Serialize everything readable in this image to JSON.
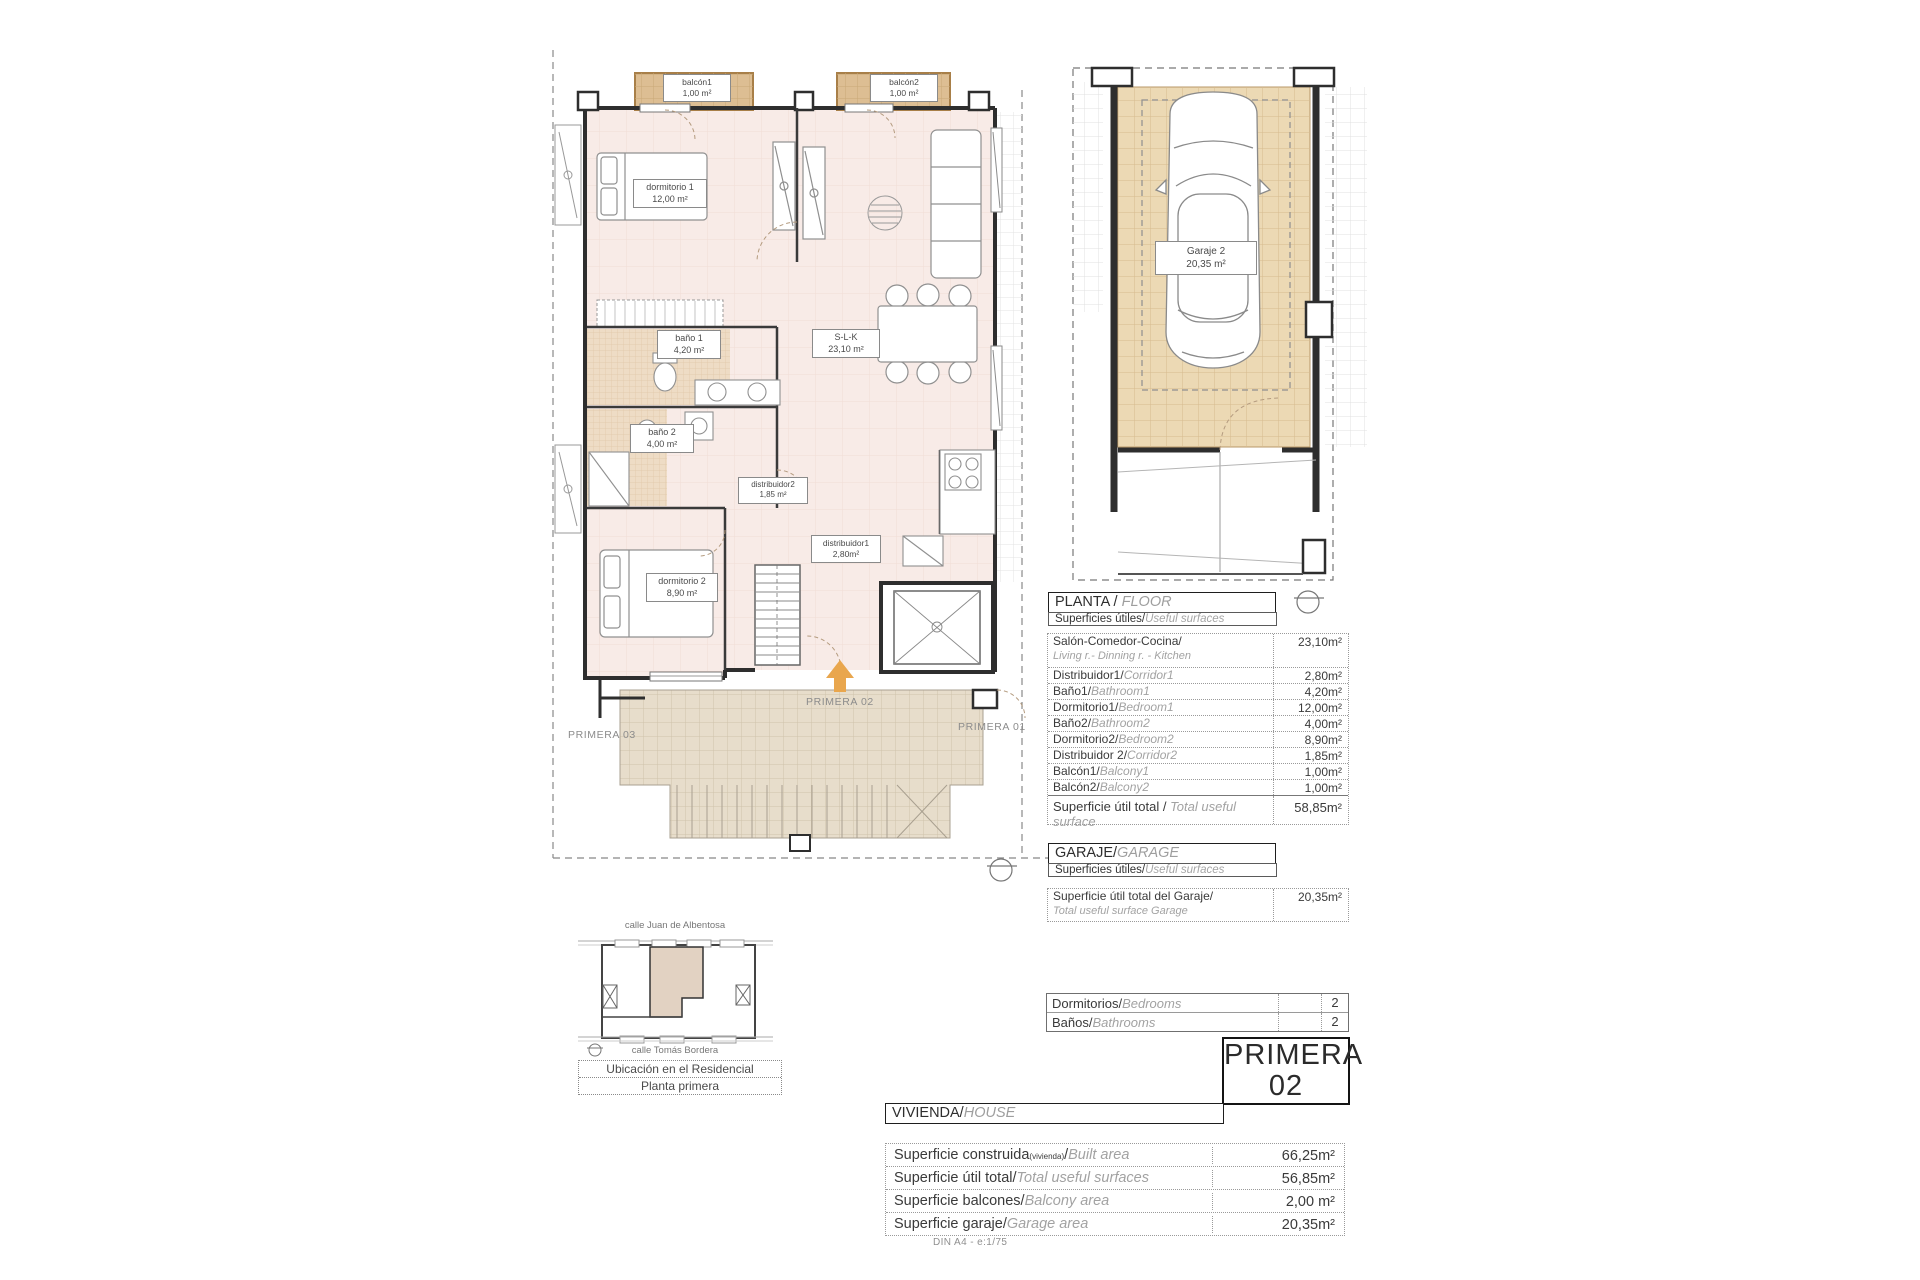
{
  "floor_plan": {
    "room_labels": {
      "balcon1": {
        "name": "balcón1",
        "area": "1,00 m²"
      },
      "balcon2": {
        "name": "balcón2",
        "area": "1,00 m²"
      },
      "dormitorio1": {
        "name": "dormitorio 1",
        "area": "12,00 m²"
      },
      "bano1": {
        "name": "baño 1",
        "area": "4,20 m²"
      },
      "bano2": {
        "name": "baño 2",
        "area": "4,00 m²"
      },
      "slk": {
        "name": "S-L-K",
        "area": "23,10 m²"
      },
      "distribuidor2": {
        "name": "distribuidor2",
        "area": "1,85 m²"
      },
      "distribuidor1": {
        "name": "distribuidor1",
        "area": "2,80m²"
      },
      "dormitorio2": {
        "name": "dormitorio 2",
        "area": "8,90 m²"
      }
    },
    "unit_annotations": {
      "left": "PRIMERA 03",
      "center": "PRIMERA 02",
      "right": "PRIMERA 01"
    }
  },
  "garage_plan": {
    "label": {
      "name": "Garaje 2",
      "area": "20,35 m²"
    }
  },
  "planta_table": {
    "title_es": "PLANTA / ",
    "title_en": "FLOOR",
    "subtitle_es": "Superficies útiles/",
    "subtitle_en": "Useful surfaces",
    "rows": [
      {
        "es": "Salón-Comedor-Cocina/",
        "en": "Living r.- Dinning r. - Kitchen",
        "value": "23,10m²"
      },
      {
        "es": "Distribuidor1/",
        "en": "Corridor1",
        "value": "2,80m²"
      },
      {
        "es": "Baño1/",
        "en": "Bathroom1",
        "value": "4,20m²"
      },
      {
        "es": "Dormitorio1/",
        "en": "Bedroom1",
        "value": "12,00m²"
      },
      {
        "es": "Baño2/",
        "en": "Bathroom2",
        "value": "4,00m²"
      },
      {
        "es": "Dormitorio2/",
        "en": "Bedroom2",
        "value": "8,90m²"
      },
      {
        "es": "Distribuidor 2/",
        "en": "Corridor2",
        "value": "1,85m²"
      },
      {
        "es": "Balcón1/",
        "en": "Balcony1",
        "value": "1,00m²"
      },
      {
        "es": "Balcón2/",
        "en": "Balcony2",
        "value": "1,00m²"
      }
    ],
    "total": {
      "es": "Superficie útil total / ",
      "en": "Total useful surface",
      "value": "58,85m²"
    }
  },
  "garaje_table": {
    "title_es": "GARAJE/",
    "title_en": "GARAGE",
    "subtitle_es": "Superficies útiles/",
    "subtitle_en": "Useful surfaces",
    "row": {
      "es": "Superficie útil total del Garaje/",
      "en": "Total useful surface Garage",
      "value": "20,35m²"
    }
  },
  "counts_table": {
    "rows": [
      {
        "es": "Dormitorios/",
        "en": "Bedrooms",
        "value": "2"
      },
      {
        "es": "Baños/",
        "en": "Bathrooms",
        "value": "2"
      }
    ]
  },
  "unit_badge": {
    "line1": "PRIMERA",
    "line2": "02"
  },
  "vivienda_table": {
    "title_es": "VIVIENDA/",
    "title_en": "HOUSE",
    "rows": [
      {
        "es": "Superficie construida",
        "note": "(vivienda)",
        "sep": "/",
        "en": "Built area",
        "value": "66,25m²"
      },
      {
        "es": "Superficie útil total/",
        "en": "Total useful surfaces",
        "value": "56,85m²"
      },
      {
        "es": "Superficie balcones/",
        "en": "Balcony area",
        "value": "2,00 m²"
      },
      {
        "es": "Superficie garaje/",
        "en": "Garage area",
        "value": "20,35m²"
      }
    ],
    "footnote": "DIN A4 - e:1/75"
  },
  "minimap": {
    "street_top": "calle Juan de Albentosa",
    "street_bottom": "calle Tomás Bordera",
    "caption1": "Ubicación en el Residencial",
    "caption2": "Planta primera"
  },
  "colors": {
    "floor_pink": "#f8ebe7",
    "balcony_tan": "#ddbe93",
    "walkway_tan": "#e7ddcb",
    "garage_tan": "#ecd9b4",
    "arrow_orange": "#e9a64d",
    "wall_dark": "#2e2e2e"
  }
}
